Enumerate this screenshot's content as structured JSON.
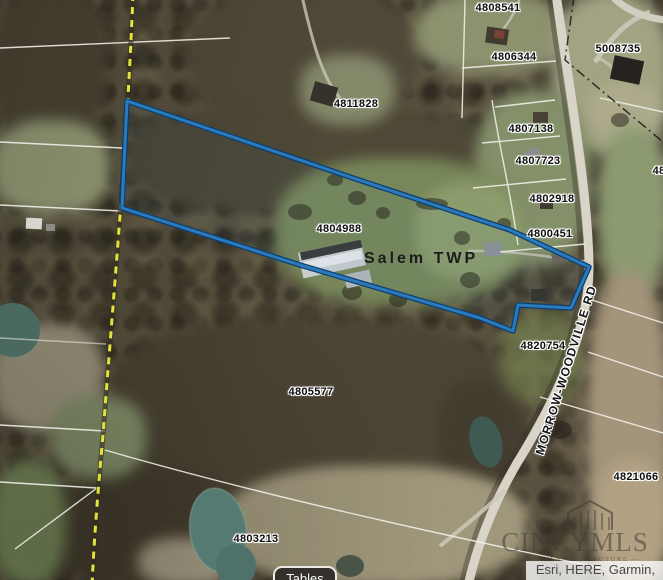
{
  "map": {
    "township_label": "Salem TWP",
    "road_label": "MORROW-WOODVILLE RD",
    "parcel_labels": [
      "4808541",
      "4806344",
      "5008735",
      "4811828",
      "4807138",
      "4807723",
      "4802918",
      "4800451",
      "4804988",
      "4820754",
      "4805577",
      "4821066",
      "4803213",
      "48"
    ],
    "selected_parcel_color": "#2b7abc",
    "selected_parcel_casing_color": "#0d3f6e",
    "road_centerline_color": "#e6e23c"
  },
  "watermark": {
    "prefix": "THE",
    "name": "CINCYMLS",
    "tagline": "— OUR MLS • OUR FUTURE —"
  },
  "attribution": {
    "text": "Esri, HERE, Garmin,"
  },
  "controls": {
    "tables_label": "Tables"
  }
}
